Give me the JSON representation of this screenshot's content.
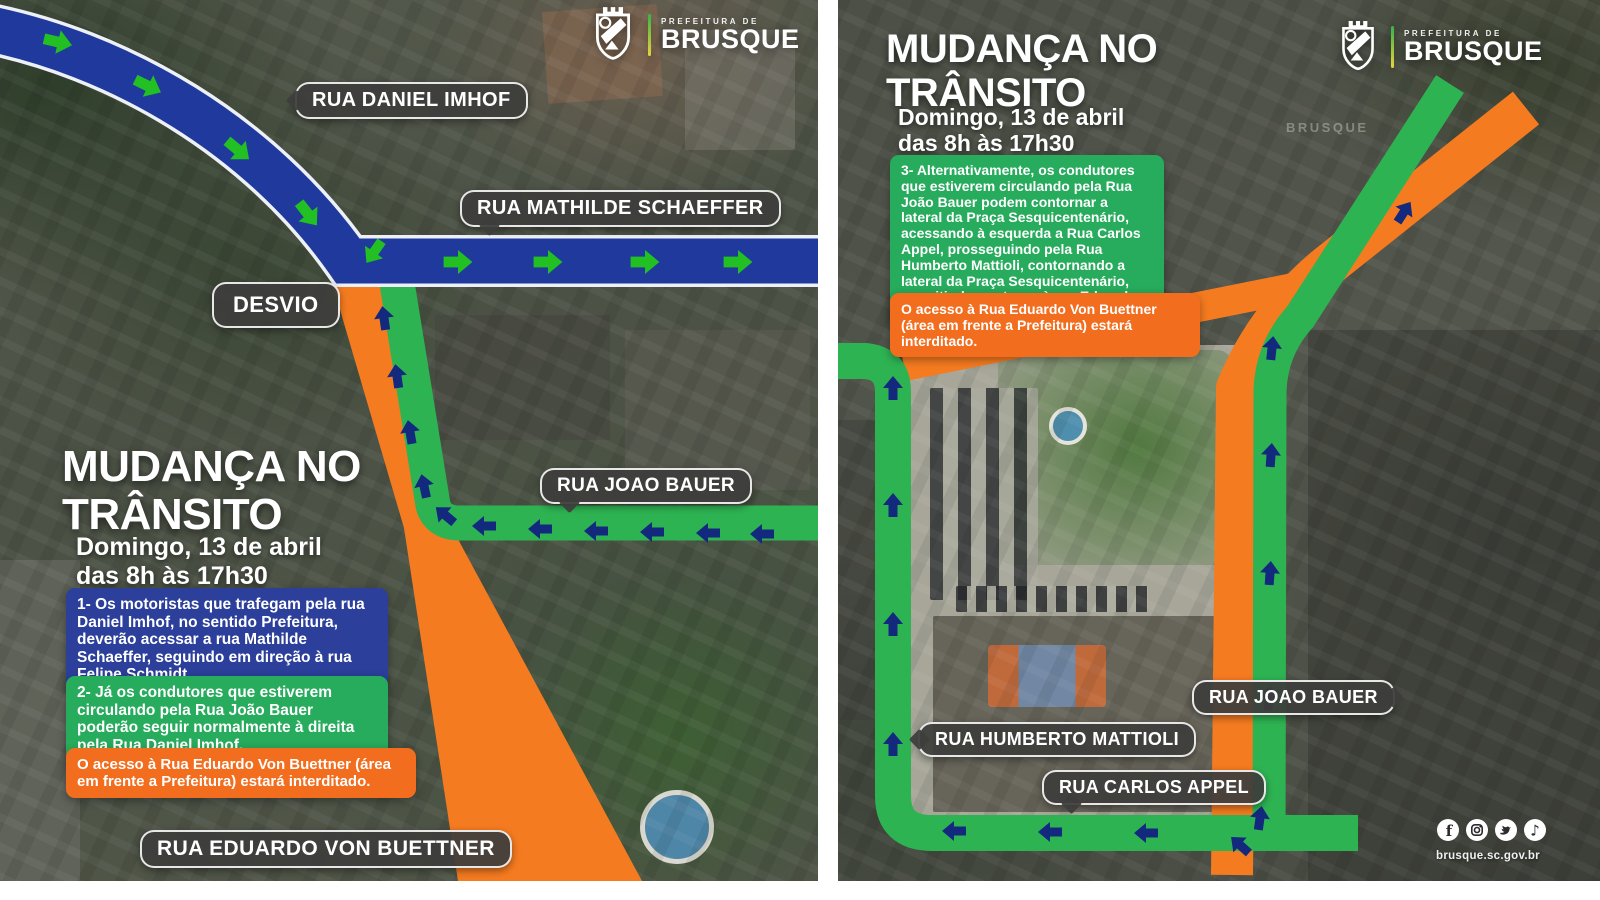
{
  "colors": {
    "route_blue": "#1f3a9c",
    "route_green": "#2eb353",
    "route_orange": "#f57b20",
    "arrow_green": "#23c023",
    "arrow_navy": "#13297e",
    "box_blue": "#2b3f9b",
    "box_green": "#27ab5c",
    "box_orange": "#f26d1e",
    "label_bg": "rgba(62,62,60,0.94)"
  },
  "posters": {
    "left": {
      "logo": {
        "small": "PREFEITURA DE",
        "name": "BRUSQUE"
      },
      "title": [
        "MUDANÇA NO",
        "TRÂNSITO"
      ],
      "date": [
        "Domingo, 13 de abril",
        "das 8h às 17h30"
      ],
      "boxes": {
        "blue": "1- Os motoristas que trafegam pela rua Daniel Imhof, no sentido Prefeitura, deverão acessar a rua Mathilde Schaeffer, seguindo em direção à rua Felipe Schmidt.",
        "green": "2- Já os condutores que estiverem circulando pela Rua João Bauer poderão seguir normalmente à direita pela Rua Daniel Imhof.",
        "orange": "O acesso à Rua Eduardo Von Buettner (área em frente a Prefeitura) estará interditado."
      },
      "labels": {
        "daniel_imhof": "RUA DANIEL IMHOF",
        "mathilde_schaeffer": "RUA MATHILDE SCHAEFFER",
        "desvio": "DESVIO",
        "joao_bauer": "RUA JOAO BAUER",
        "eduardo_von_buettner": "RUA EDUARDO VON BUETTNER"
      }
    },
    "right": {
      "logo": {
        "small": "PREFEITURA DE",
        "name": "BRUSQUE"
      },
      "watermark": "BRUSQUE",
      "title": [
        "MUDANÇA NO",
        "TRÂNSITO"
      ],
      "date": [
        "Domingo, 13 de abril",
        "das 8h às 17h30"
      ],
      "boxes": {
        "green": "3- Alternativamente, os condutores que estiverem circulando pela Rua João Bauer podem contornar a lateral da Praça Sesquicentenário, acessando à esquerda a Rua Carlos Appel, prosseguindo pela Rua Humberto Mattioli, contornando a lateral da Praça Sesquicentenário, permitindo o retorno à rua Eduardo Von Buettner.",
        "orange": "O acesso à Rua Eduardo Von Buettner (área em frente a Prefeitura) estará interditado."
      },
      "labels": {
        "joao_bauer": "RUA JOAO BAUER",
        "humberto_mattioli": "RUA HUMBERTO MATTIOLI",
        "carlos_appel": "RUA CARLOS APPEL"
      },
      "footer": {
        "website": "brusque.sc.gov.br",
        "social": [
          "facebook",
          "instagram",
          "twitter",
          "tiktok"
        ]
      }
    }
  }
}
